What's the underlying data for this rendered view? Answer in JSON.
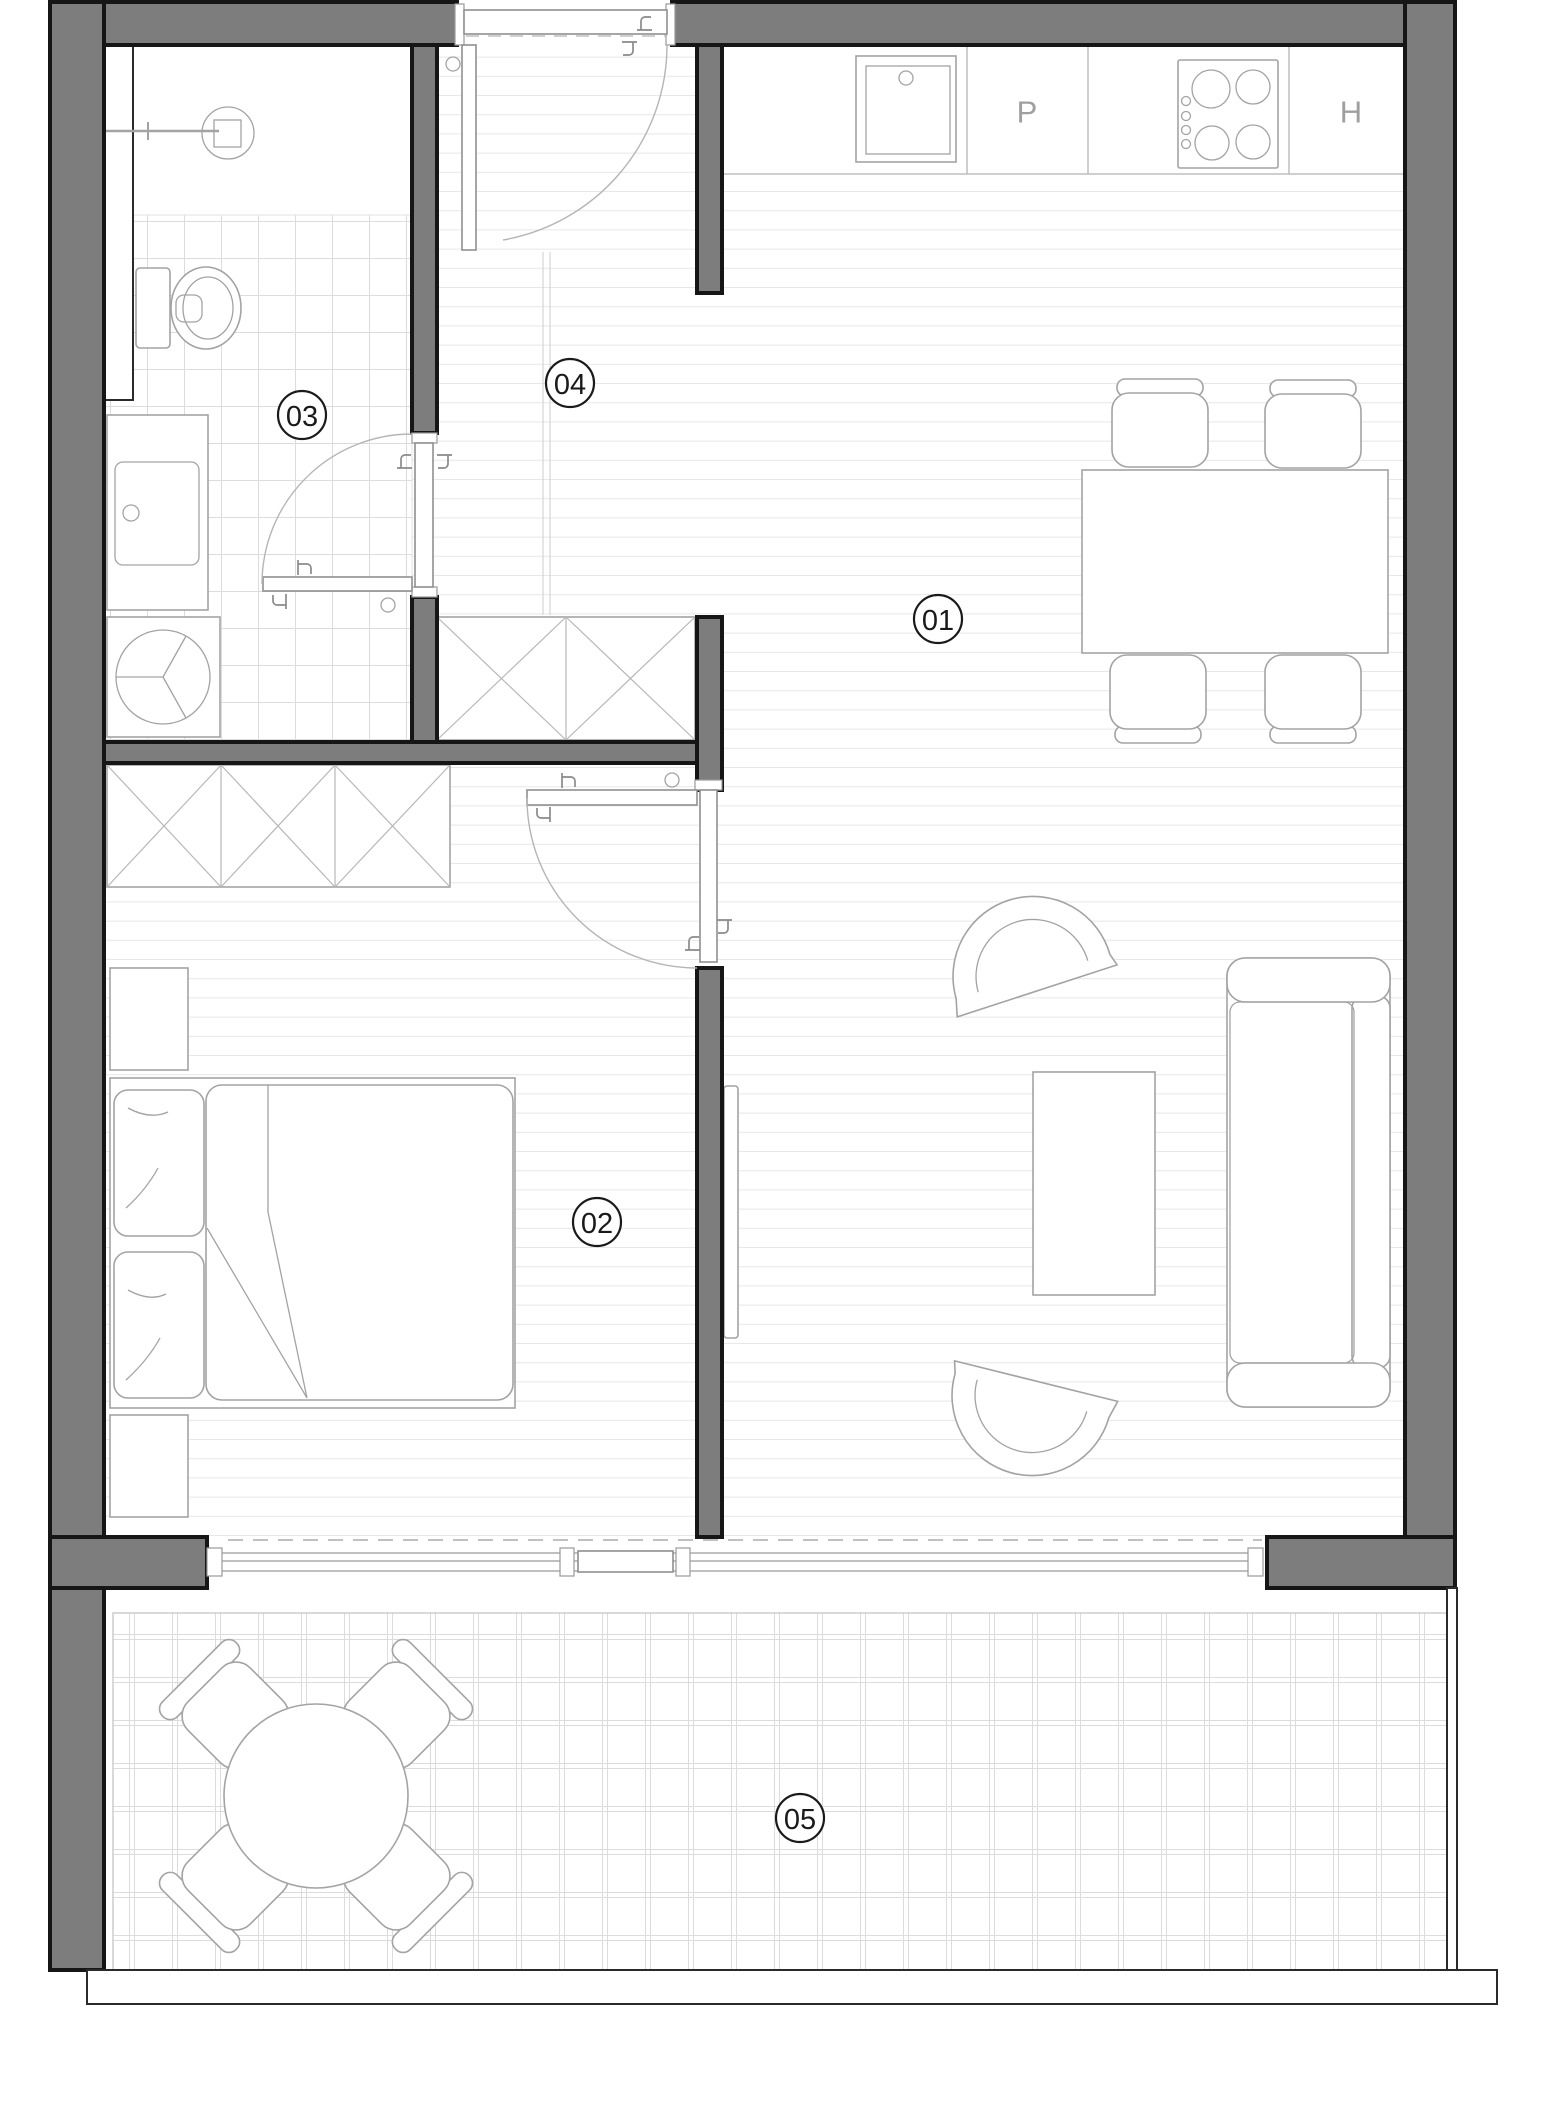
{
  "title": "apartment-floor-plan",
  "rooms": [
    {
      "id": "living-dining",
      "label": "01"
    },
    {
      "id": "bedroom",
      "label": "02"
    },
    {
      "id": "bathroom",
      "label": "03"
    },
    {
      "id": "hallway",
      "label": "04"
    },
    {
      "id": "balcony",
      "label": "05"
    }
  ],
  "kitchen": {
    "dishwasher_letter": "P",
    "fridge_letter": "H"
  },
  "theme": {
    "wall": "#7d7d7d",
    "outline": "#161616",
    "furniture": "#a3a3a3",
    "plank": "#e7e7e7",
    "tile": "#dcdcdc",
    "label": "#1a1a1a"
  }
}
